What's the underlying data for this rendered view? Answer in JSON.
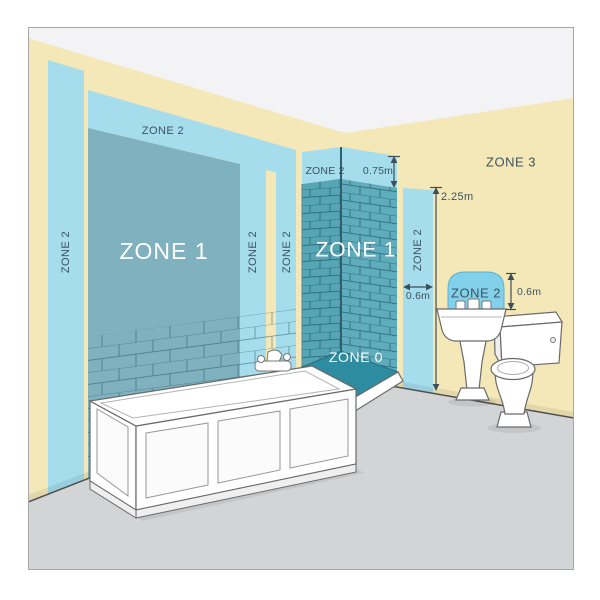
{
  "diagram": {
    "labels": {
      "zone1_bath": "ZONE 1",
      "zone1_shower": "ZONE 1",
      "zone0": "ZONE 0",
      "zone3": "ZONE 3",
      "zone2_left": "ZONE 2",
      "zone2_top": "ZONE 2",
      "zone2_strip_a": "ZONE 2",
      "zone2_strip_b": "ZONE 2",
      "zone2_shower_top": "ZONE 2",
      "zone2_shower_side": "ZONE 2",
      "zone2_sink": "ZONE 2"
    },
    "measurements": {
      "shower_above": "0.75m",
      "zone_height": "2.25m",
      "shower_side_width": "0.6m",
      "sink_above": "0.6m"
    }
  },
  "colors": {
    "wall": "#f4e8b8",
    "ceiling": "#f3f3f6",
    "floor": "#d3d4d6",
    "zone2": "#a6ddec",
    "zone2_arch": "#83d0ea",
    "zone1": "#7fb1bf",
    "shower_tile_left": "#56a5b5",
    "shower_tile_right": "#5fadbc",
    "zone0": "#2e8ca0",
    "label_dark": "#3d5260",
    "label_light": "#ffffff"
  }
}
